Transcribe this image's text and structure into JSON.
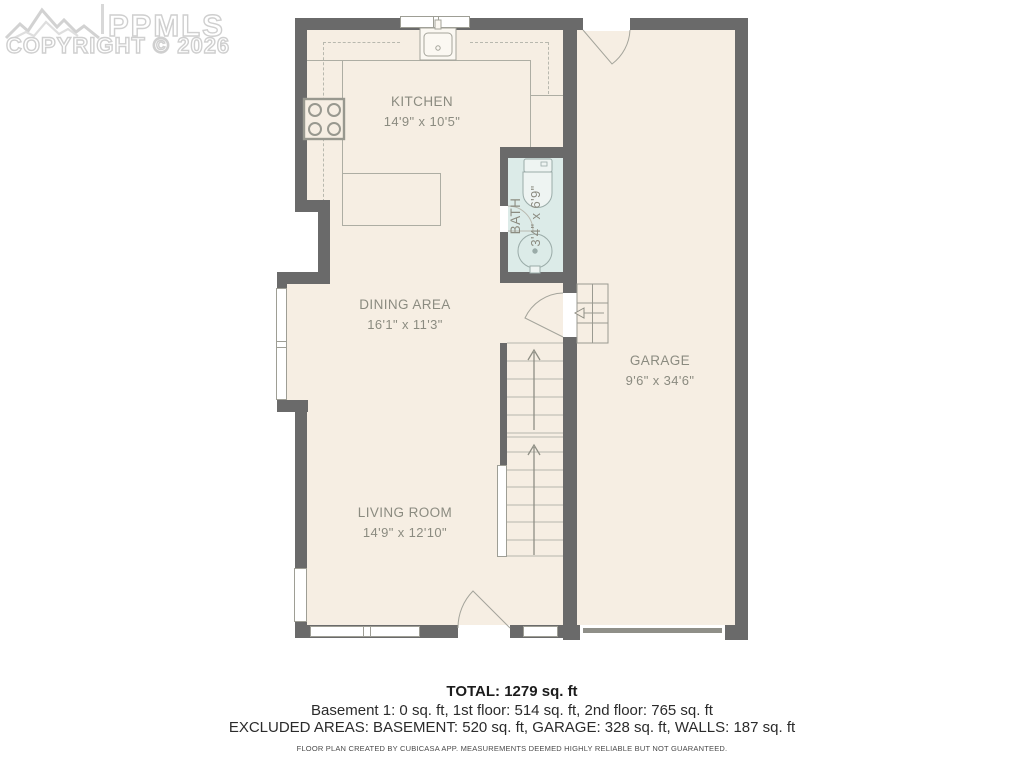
{
  "watermark": {
    "brand": "PPMLS",
    "copyright": "COPYRIGHT © 2026",
    "logo_icon": "mountains-logo"
  },
  "rooms": [
    {
      "id": "kitchen",
      "name": "KITCHEN",
      "dims": "14'9\" x 10'5\""
    },
    {
      "id": "bath",
      "name": "BATH",
      "dims": "3'4\" x 6'9\""
    },
    {
      "id": "dining",
      "name": "DINING AREA",
      "dims": "16'1\" x 11'3\""
    },
    {
      "id": "garage",
      "name": "GARAGE",
      "dims": "9'6\" x 34'6\""
    },
    {
      "id": "living",
      "name": "LIVING ROOM",
      "dims": "14'9\" x 12'10\""
    }
  ],
  "summary": {
    "total": "TOTAL: 1279 sq. ft",
    "floors": "Basement 1: 0 sq. ft, 1st floor: 514 sq. ft, 2nd floor: 765 sq. ft",
    "excluded": "EXCLUDED AREAS: BASEMENT: 520 sq. ft, GARAGE: 328 sq. ft, WALLS: 187 sq. ft",
    "disclaimer": "FLOOR PLAN CREATED BY CUBICASA APP. MEASUREMENTS DEEMED HIGHLY RELIABLE BUT NOT GUARANTEED."
  },
  "colors": {
    "floor": "#f6eee3",
    "bath_floor": "#dcebe8",
    "wall": "#6a6a6a",
    "label_text": "#8b8b80",
    "watermark": "#cfcfcf"
  }
}
